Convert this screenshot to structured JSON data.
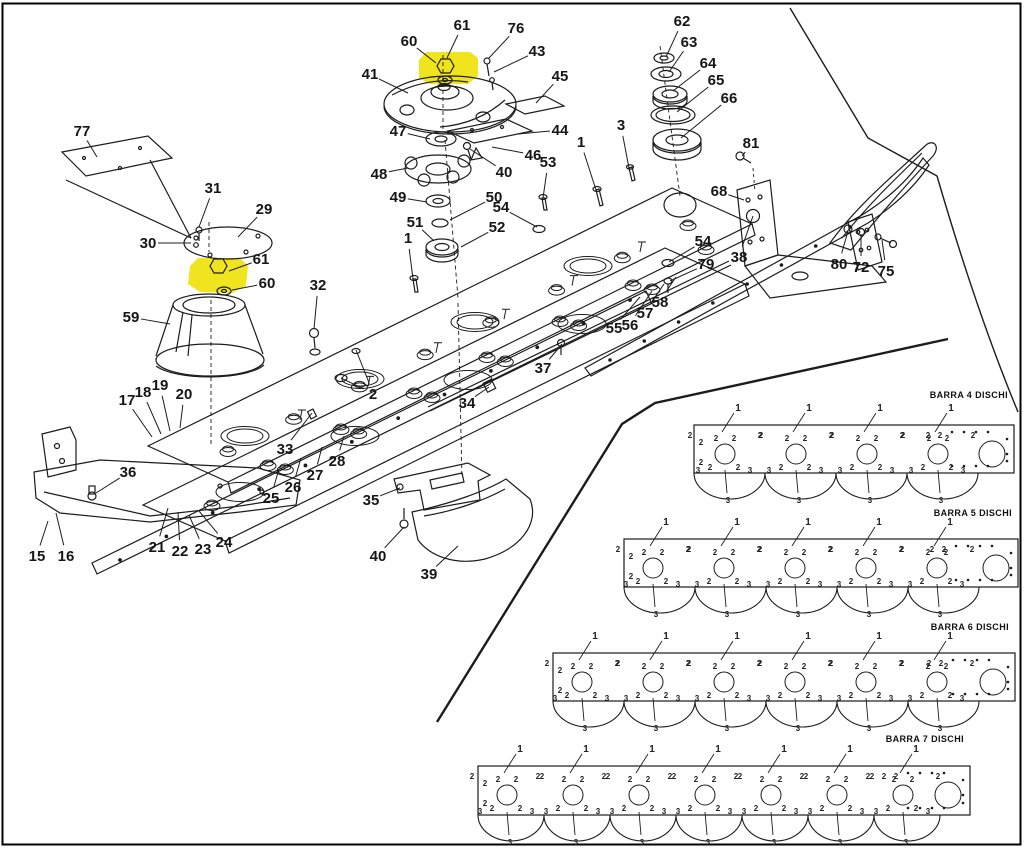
{
  "page": {
    "background": "#ffffff",
    "line_color": "#1c1c1c",
    "highlight_color": "#f0e41e",
    "frame_color": "#000000",
    "highlighted_parts": [
      "60",
      "61"
    ]
  },
  "diagram": {
    "callouts": [
      {
        "n": "60",
        "x": 409,
        "y": 41,
        "tx": 436,
        "ty": 63
      },
      {
        "n": "61",
        "x": 462,
        "y": 25,
        "tx": 447,
        "ty": 58
      },
      {
        "n": "76",
        "x": 516,
        "y": 28,
        "tx": 489,
        "ty": 58
      },
      {
        "n": "43",
        "x": 537,
        "y": 51,
        "tx": 494,
        "ty": 72
      },
      {
        "n": "41",
        "x": 370,
        "y": 74,
        "tx": 408,
        "ty": 93
      },
      {
        "n": "45",
        "x": 560,
        "y": 76,
        "tx": 536,
        "ty": 103
      },
      {
        "n": "62",
        "x": 682,
        "y": 21,
        "tx": 666,
        "ty": 57
      },
      {
        "n": "63",
        "x": 689,
        "y": 42,
        "tx": 669,
        "ty": 72
      },
      {
        "n": "64",
        "x": 708,
        "y": 63,
        "tx": 673,
        "ty": 91
      },
      {
        "n": "65",
        "x": 716,
        "y": 80,
        "tx": 677,
        "ty": 112
      },
      {
        "n": "66",
        "x": 729,
        "y": 98,
        "tx": 681,
        "ty": 138
      },
      {
        "n": "47",
        "x": 398,
        "y": 131,
        "tx": 430,
        "ty": 139
      },
      {
        "n": "44",
        "x": 560,
        "y": 130,
        "tx": 518,
        "ty": 134
      },
      {
        "n": "48",
        "x": 379,
        "y": 174,
        "tx": 408,
        "ty": 168
      },
      {
        "n": "46",
        "x": 533,
        "y": 155,
        "tx": 492,
        "ty": 147
      },
      {
        "n": "40",
        "x": 504,
        "y": 172,
        "tx": 470,
        "ty": 149
      },
      {
        "n": "53",
        "x": 548,
        "y": 162,
        "tx": 543,
        "ty": 198
      },
      {
        "n": "1",
        "x": 581,
        "y": 142,
        "tx": 596,
        "ty": 190
      },
      {
        "n": "3",
        "x": 621,
        "y": 125,
        "tx": 629,
        "ty": 168
      },
      {
        "n": "49",
        "x": 398,
        "y": 197,
        "tx": 427,
        "ty": 202
      },
      {
        "n": "50",
        "x": 494,
        "y": 197,
        "tx": 450,
        "ty": 220
      },
      {
        "n": "54",
        "x": 501,
        "y": 207,
        "tx": 537,
        "ty": 227
      },
      {
        "n": "51",
        "x": 415,
        "y": 222,
        "tx": 434,
        "ty": 241
      },
      {
        "n": "52",
        "x": 497,
        "y": 227,
        "tx": 461,
        "ty": 247
      },
      {
        "n": "1",
        "x": 408,
        "y": 238,
        "tx": 413,
        "ty": 279
      },
      {
        "n": "77",
        "x": 82,
        "y": 131,
        "tx": 97,
        "ty": 157
      },
      {
        "n": "31",
        "x": 213,
        "y": 188,
        "tx": 199,
        "ty": 227
      },
      {
        "n": "29",
        "x": 264,
        "y": 209,
        "tx": 238,
        "ty": 237
      },
      {
        "n": "30",
        "x": 148,
        "y": 243,
        "tx": 191,
        "ty": 243
      },
      {
        "n": "61",
        "x": 261,
        "y": 259,
        "tx": 229,
        "ty": 271
      },
      {
        "n": "60",
        "x": 267,
        "y": 283,
        "tx": 232,
        "ty": 290
      },
      {
        "n": "32",
        "x": 318,
        "y": 285,
        "tx": 314,
        "ty": 329
      },
      {
        "n": "59",
        "x": 131,
        "y": 317,
        "tx": 170,
        "ty": 324
      },
      {
        "n": "68",
        "x": 719,
        "y": 191,
        "tx": 744,
        "ty": 200
      },
      {
        "n": "81",
        "x": 751,
        "y": 143,
        "tx": 742,
        "ty": 156
      },
      {
        "n": "38",
        "x": 739,
        "y": 257,
        "tx": 753,
        "ty": 216
      },
      {
        "n": "80",
        "x": 839,
        "y": 264,
        "tx": 848,
        "ty": 231
      },
      {
        "n": "72",
        "x": 861,
        "y": 267,
        "tx": 861,
        "ty": 234
      },
      {
        "n": "75",
        "x": 886,
        "y": 271,
        "tx": 882,
        "ty": 240
      },
      {
        "n": "54",
        "x": 703,
        "y": 241,
        "tx": 669,
        "ty": 262
      },
      {
        "n": "79",
        "x": 706,
        "y": 264,
        "tx": 670,
        "ty": 281
      },
      {
        "n": "58",
        "x": 660,
        "y": 302,
        "tx": 676,
        "ty": 277
      },
      {
        "n": "57",
        "x": 645,
        "y": 313,
        "tx": 664,
        "ty": 284
      },
      {
        "n": "56",
        "x": 630,
        "y": 325,
        "tx": 652,
        "ty": 291
      },
      {
        "n": "55",
        "x": 614,
        "y": 328,
        "tx": 640,
        "ty": 297
      },
      {
        "n": "37",
        "x": 543,
        "y": 368,
        "tx": 562,
        "ty": 344
      },
      {
        "n": "34",
        "x": 467,
        "y": 403,
        "tx": 489,
        "ty": 387
      },
      {
        "n": "2",
        "x": 373,
        "y": 394,
        "tx": 341,
        "ty": 378,
        "tx2": 356,
        "ty2": 350
      },
      {
        "n": "33",
        "x": 285,
        "y": 449,
        "tx": 312,
        "ty": 413
      },
      {
        "n": "17",
        "x": 127,
        "y": 400,
        "tx": 152,
        "ty": 437
      },
      {
        "n": "18",
        "x": 143,
        "y": 392,
        "tx": 161,
        "ty": 434
      },
      {
        "n": "19",
        "x": 160,
        "y": 385,
        "tx": 170,
        "ty": 431
      },
      {
        "n": "20",
        "x": 184,
        "y": 394,
        "tx": 180,
        "ty": 428
      },
      {
        "n": "36",
        "x": 128,
        "y": 472,
        "tx": 96,
        "ty": 493
      },
      {
        "n": "15",
        "x": 37,
        "y": 556,
        "tx": 48,
        "ty": 521
      },
      {
        "n": "16",
        "x": 66,
        "y": 556,
        "tx": 56,
        "ty": 513
      },
      {
        "n": "21",
        "x": 157,
        "y": 547,
        "tx": 168,
        "ty": 508
      },
      {
        "n": "22",
        "x": 180,
        "y": 551,
        "tx": 178,
        "ty": 512
      },
      {
        "n": "23",
        "x": 203,
        "y": 549,
        "tx": 189,
        "ty": 515
      },
      {
        "n": "24",
        "x": 224,
        "y": 542,
        "tx": 199,
        "ty": 511
      },
      {
        "n": "25",
        "x": 271,
        "y": 498,
        "tx": 279,
        "ty": 469
      },
      {
        "n": "26",
        "x": 293,
        "y": 487,
        "tx": 301,
        "ty": 458
      },
      {
        "n": "27",
        "x": 315,
        "y": 475,
        "tx": 322,
        "ty": 447
      },
      {
        "n": "28",
        "x": 337,
        "y": 461,
        "tx": 344,
        "ty": 436
      },
      {
        "n": "35",
        "x": 371,
        "y": 500,
        "tx": 400,
        "ty": 488
      },
      {
        "n": "40",
        "x": 378,
        "y": 556,
        "tx": 404,
        "ty": 527
      },
      {
        "n": "39",
        "x": 429,
        "y": 574,
        "tx": 458,
        "ty": 546
      }
    ]
  },
  "barras": {
    "position_markers": [
      "1",
      "2",
      "3"
    ],
    "items": [
      {
        "label": "BARRA 4 DISCHI",
        "discs": 4,
        "x": 694,
        "y": 425,
        "w": 320,
        "h": 48,
        "spacing": 71,
        "first_dx": 31,
        "label_y": 390
      },
      {
        "label": "BARRA 5 DISCHI",
        "discs": 5,
        "x": 624,
        "y": 539,
        "w": 394,
        "h": 48,
        "spacing": 71,
        "first_dx": 29,
        "label_y": 508
      },
      {
        "label": "BARRA 6 DISCHI",
        "discs": 6,
        "x": 553,
        "y": 653,
        "w": 462,
        "h": 48,
        "spacing": 71,
        "first_dx": 29,
        "label_y": 622
      },
      {
        "label": "BARRA 7 DISCHI",
        "discs": 7,
        "x": 478,
        "y": 766,
        "w": 492,
        "h": 49,
        "spacing": 66,
        "first_dx": 29,
        "label_y": 734
      }
    ]
  }
}
